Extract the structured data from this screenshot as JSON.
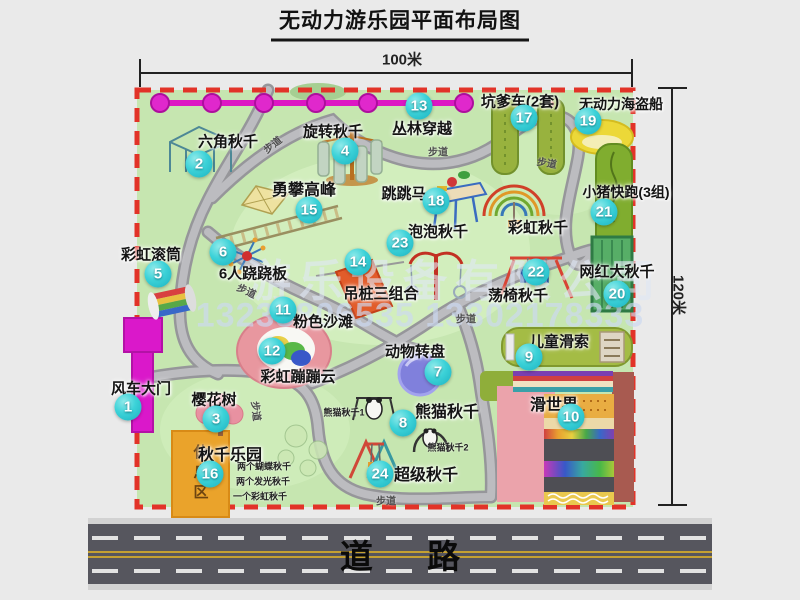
{
  "page": {
    "title": "无动力游乐园平面布局图"
  },
  "scale": {
    "top": "100米",
    "right": "120米"
  },
  "road": {
    "label": "道  路"
  },
  "watermark": {
    "company": "游乐设备有限公司",
    "phones": "13233806535 13302178333"
  },
  "rest_area": "休息区",
  "extras": {
    "rainbow_swing": "彩虹秋千"
  },
  "walkway_text": "步道",
  "walkway_labels": [
    {
      "x": 272,
      "y": 144,
      "r": -38
    },
    {
      "x": 438,
      "y": 151,
      "r": 0
    },
    {
      "x": 547,
      "y": 162,
      "r": 10
    },
    {
      "x": 247,
      "y": 290,
      "r": 25
    },
    {
      "x": 466,
      "y": 318,
      "r": 0
    },
    {
      "x": 257,
      "y": 411,
      "r": 83
    },
    {
      "x": 386,
      "y": 500,
      "r": 0
    }
  ],
  "attractions": [
    {
      "num": "1",
      "name": "风车大门",
      "lx": 141,
      "ly": 388,
      "bx": 128,
      "by": 407
    },
    {
      "num": "2",
      "name": "六角秋千",
      "lx": 228,
      "ly": 141,
      "bx": 199,
      "by": 164
    },
    {
      "num": "3",
      "name": "樱花树",
      "lx": 214,
      "ly": 399,
      "bx": 216,
      "by": 419
    },
    {
      "num": "4",
      "name": "旋转秋千",
      "lx": 333,
      "ly": 131,
      "bx": 345,
      "by": 151
    },
    {
      "num": "5",
      "name": "彩虹滚筒",
      "lx": 151,
      "ly": 254,
      "bx": 158,
      "by": 274
    },
    {
      "num": "6",
      "name": "6人跷跷板",
      "lx": 253,
      "ly": 273,
      "bx": 223,
      "by": 252
    },
    {
      "num": "7",
      "name": "动物转盘",
      "lx": 415,
      "ly": 351,
      "bx": 438,
      "by": 372
    },
    {
      "num": "8",
      "name": "熊猫秋千",
      "lx": 447,
      "ly": 410,
      "bx": 403,
      "by": 423,
      "fs": 16,
      "subs": [
        {
          "text": "熊猫秋千1",
          "x": 344,
          "y": 412
        },
        {
          "text": "熊猫秋千2",
          "x": 448,
          "y": 447
        }
      ]
    },
    {
      "num": "9",
      "name": "儿童滑索",
      "lx": 559,
      "ly": 341,
      "bx": 529,
      "by": 357
    },
    {
      "num": "10",
      "name": "滑世界",
      "lx": 554,
      "ly": 403,
      "bx": 571,
      "by": 417,
      "fs": 16
    },
    {
      "num": "11",
      "name": "粉色沙滩",
      "lx": 323,
      "ly": 321,
      "bx": 283,
      "by": 310
    },
    {
      "num": "12",
      "name": "彩虹蹦蹦云",
      "lx": 298,
      "ly": 376,
      "bx": 272,
      "by": 351
    },
    {
      "num": "13",
      "name": "丛林穿越",
      "lx": 422,
      "ly": 128,
      "bx": 419,
      "by": 106
    },
    {
      "num": "14",
      "name": "吊桩三组合",
      "lx": 381,
      "ly": 293,
      "bx": 358,
      "by": 262
    },
    {
      "num": "15",
      "name": "勇攀高峰",
      "lx": 304,
      "ly": 188,
      "bx": 309,
      "by": 210,
      "fs": 16
    },
    {
      "num": "16",
      "name": "秋千乐园",
      "lx": 230,
      "ly": 453,
      "bx": 210,
      "by": 474,
      "fs": 16,
      "subs": [
        {
          "text": "两个蝴蝶秋千",
          "x": 264,
          "y": 466
        },
        {
          "text": "两个发光秋千",
          "x": 263,
          "y": 481
        },
        {
          "text": "一个彩虹秋千",
          "x": 260,
          "y": 496
        }
      ]
    },
    {
      "num": "17",
      "name": "坑爹车(2套)",
      "lx": 520,
      "ly": 101,
      "bx": 524,
      "by": 118
    },
    {
      "num": "18",
      "name": "跳跳马",
      "lx": 404,
      "ly": 193,
      "bx": 436,
      "by": 201
    },
    {
      "num": "19",
      "name": "无动力海盗船",
      "lx": 621,
      "ly": 104,
      "bx": 588,
      "by": 121,
      "fs": 14
    },
    {
      "num": "20",
      "name": "网红大秋千",
      "lx": 617,
      "ly": 271,
      "bx": 617,
      "by": 294
    },
    {
      "num": "21",
      "name": "小猪快跑(3组)",
      "lx": 626,
      "ly": 192,
      "bx": 604,
      "by": 212,
      "fs": 14
    },
    {
      "num": "22",
      "name": "荡椅秋千",
      "lx": 518,
      "ly": 295,
      "bx": 536,
      "by": 272
    },
    {
      "num": "23",
      "name": "泡泡秋千",
      "lx": 438,
      "ly": 231,
      "bx": 400,
      "by": 243
    },
    {
      "num": "24",
      "name": "超级秋千",
      "lx": 426,
      "ly": 473,
      "bx": 380,
      "by": 474,
      "fs": 16
    },
    {
      "num": "",
      "name": "彩虹秋千",
      "lx": 538,
      "ly": 227,
      "bx": 0,
      "by": 0
    }
  ],
  "colors": {
    "map_green": "#c6e6b0",
    "border_red": "#e23328",
    "badge_cyan": "#2cc8d2",
    "magenta": "#da18ca",
    "road_gray": "#56565e",
    "lane_yellow": "#c4a032"
  }
}
